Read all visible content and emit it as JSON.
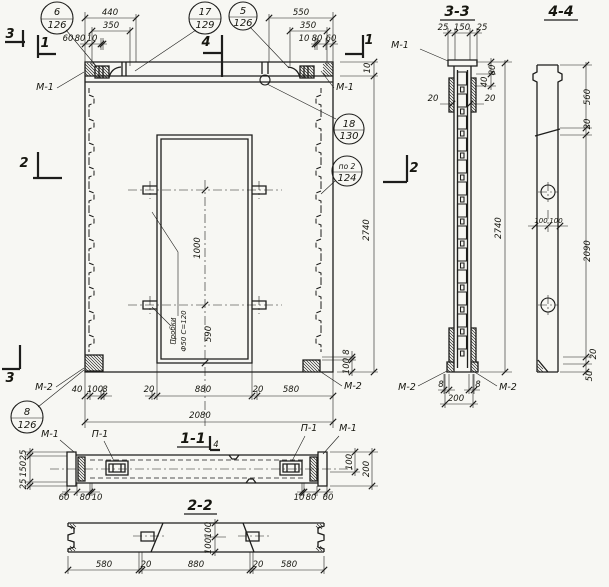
{
  "drawing": {
    "kind": "precast concrete panel working drawing",
    "ink": "#1d1d1b",
    "paper": "#f7f7f3"
  },
  "callouts": {
    "c6": {
      "top": "6",
      "bottom": "126"
    },
    "c17": {
      "top": "17",
      "bottom": "129"
    },
    "c5": {
      "top": "5",
      "bottom": "126"
    },
    "c18": {
      "top": "18",
      "bottom": "130"
    },
    "c124": {
      "top": "по 2",
      "bottom": "124"
    },
    "c8": {
      "top": "8",
      "bottom": "126"
    }
  },
  "sections": {
    "s11": "1-1",
    "s22": "2-2",
    "s33": "3-3",
    "s44": "4-4"
  },
  "marks": {
    "m1": "1",
    "m2": "2",
    "m3": "3",
    "m4": "4"
  },
  "labels": {
    "m1": "М-1",
    "m2": "М-2",
    "p1": "П-1"
  },
  "note": {
    "line1": "Пробки",
    "line2": "Ф50 С=120"
  },
  "dims": {
    "d8": "8",
    "d10": "10",
    "d20": "20",
    "d25": "25",
    "d40": "40",
    "d50": "50",
    "d60": "60",
    "d80": "80",
    "d100": "100",
    "d150": "150",
    "d200": "200",
    "d350": "350",
    "d440": "440",
    "d550": "550",
    "d560": "560",
    "d580": "580",
    "d590": "590",
    "d880": "880",
    "d1000": "1000",
    "d2080": "2080",
    "d2090": "2090",
    "d2740": "2740"
  }
}
